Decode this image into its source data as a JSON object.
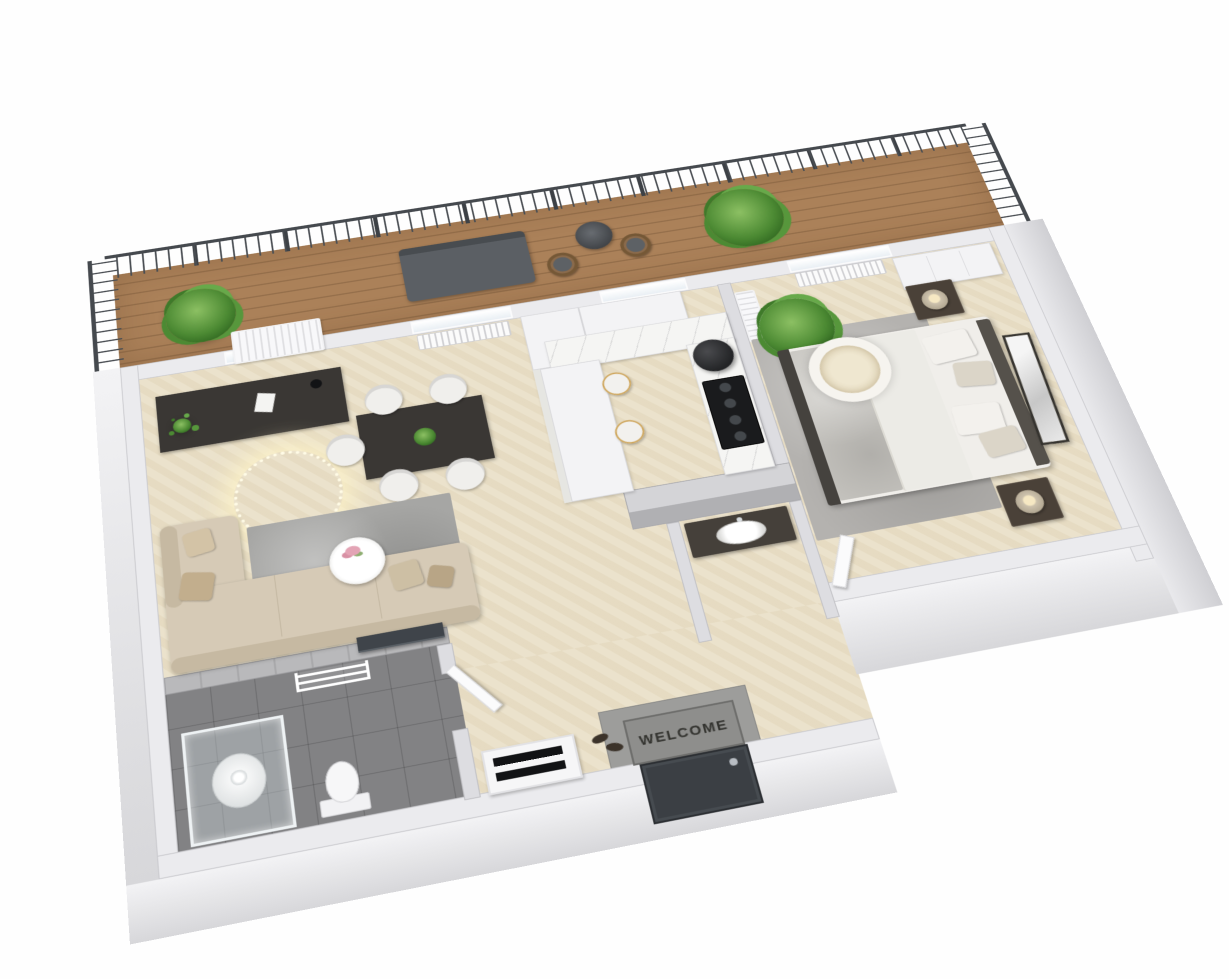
{
  "scene": {
    "description": "3D isometric floor-plan rendering of a one-bedroom apartment with a long wooden terrace",
    "background_color": "#ffffff",
    "welcome_mat": {
      "label": "WELCOME"
    },
    "palette": {
      "exterior_wall": "#ebebee",
      "interior_wall": "#dddde1",
      "wood_floor": "#eae0c8",
      "bathroom_tile": "#828284",
      "terrace_deck": "#ab8159",
      "railing": "#45494e",
      "dark_furniture": "#3a3734",
      "sofa_beige": "#d6cab6",
      "rug_gray": "#a6a6a4",
      "plant_green": "#4c8a33",
      "kitchen_marble": "#f5f5f3",
      "entry_door": "#3b3f44"
    },
    "rooms": [
      {
        "name": "terrace",
        "features": [
          "wood-deck",
          "metal-railing",
          "outdoor-sofa",
          "bistro-table",
          "rattan-chairs",
          "potted-plants",
          "air-conditioner"
        ]
      },
      {
        "name": "living-dining-room",
        "features": [
          "desk",
          "dining-table",
          "five-dining-chairs",
          "string-light-ring",
          "area-rug",
          "corner-sofa",
          "coffee-table-with-flowers",
          "tv",
          "radiator",
          "windows"
        ]
      },
      {
        "name": "kitchen",
        "features": [
          "upper-cabinets",
          "marble-countertop",
          "black-cooktop",
          "cylindrical-hood",
          "breakfast-peninsula",
          "two-bar-stools"
        ]
      },
      {
        "name": "bedroom",
        "features": [
          "double-bed",
          "ring-ceiling-light",
          "two-nightstands",
          "table-lamps",
          "wardrobe",
          "leaning-frame",
          "palm-plant",
          "rug",
          "radiator",
          "air-conditioner",
          "open-door"
        ]
      },
      {
        "name": "bathroom",
        "features": [
          "glass-shower",
          "toilet",
          "heated-towel-rail",
          "open-door",
          "tiled-walls"
        ]
      },
      {
        "name": "entry-hall",
        "features": [
          "welcome-mat",
          "dark-entry-door",
          "shoe-rack",
          "shoes",
          "washbasin-vanity",
          "stone-landing"
        ]
      }
    ]
  }
}
